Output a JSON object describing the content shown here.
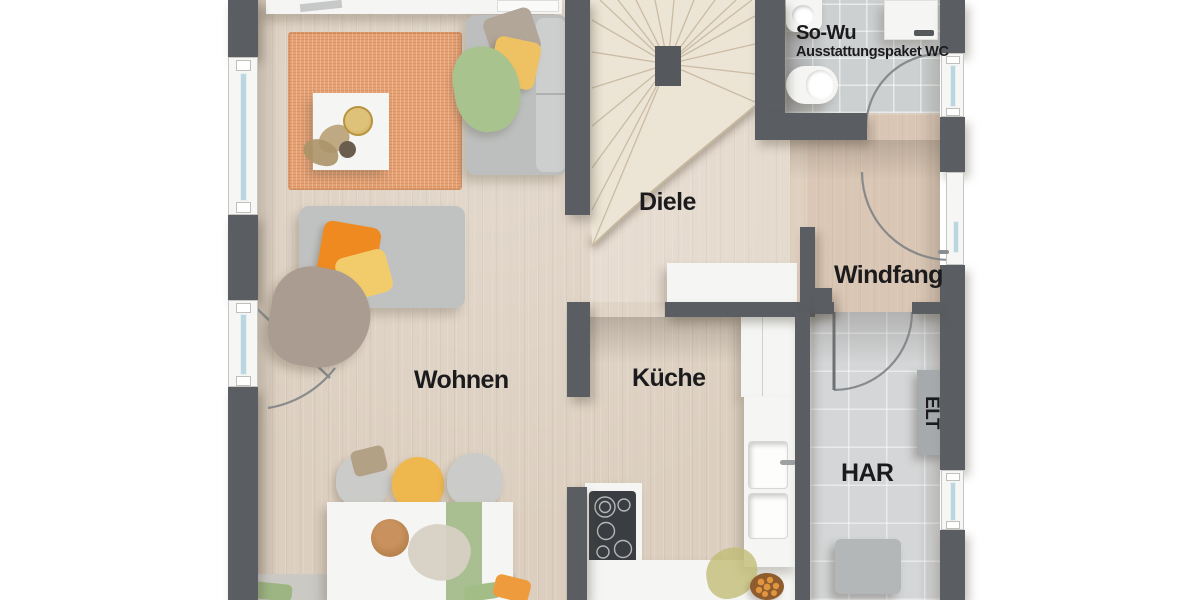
{
  "floorplan": {
    "wc": {
      "label": "So-Wu",
      "sublabel": "Ausstattungspaket WC"
    },
    "rooms": [
      {
        "id": "wohnen",
        "label": "Wohnen"
      },
      {
        "id": "kueche",
        "label": "Küche"
      },
      {
        "id": "diele",
        "label": "Diele"
      },
      {
        "id": "windfang",
        "label": "Windfang"
      },
      {
        "id": "har",
        "label": "HAR"
      },
      {
        "id": "elt",
        "label": "ELT"
      }
    ],
    "colors": {
      "wall": "#5a5e62",
      "wood_floor": "#dccfc0",
      "wc_tile_floor": "#ccd0d1",
      "har_tile_floor": "#d4d6d7",
      "stair_wood": "#ece4d5",
      "rug_orange": "#e7a173",
      "sofa_gray": "#c2c4c3",
      "pillow_orange": "#ef8a20",
      "pillow_yellow": "#eec263",
      "throw_green": "#a9c38f",
      "blanket_taupe": "#aa9c90",
      "chair_yellow": "#efb84f",
      "runner_green": "#a9bf92",
      "window_glass": "#bcd6e0",
      "label_text": "#1b1b1d"
    },
    "fixtures": [
      "stairs",
      "wc-sink",
      "wc-toilet",
      "water-heater",
      "diele-console",
      "kitchen-tall-cabinet",
      "kitchen-sink",
      "cooktop",
      "elt-cabinet",
      "har-appliance",
      "entrance-door",
      "terrace-door",
      "sofa",
      "chaise",
      "coffee-table",
      "dining-table",
      "dining-chairs",
      "fruit-bowl"
    ]
  }
}
